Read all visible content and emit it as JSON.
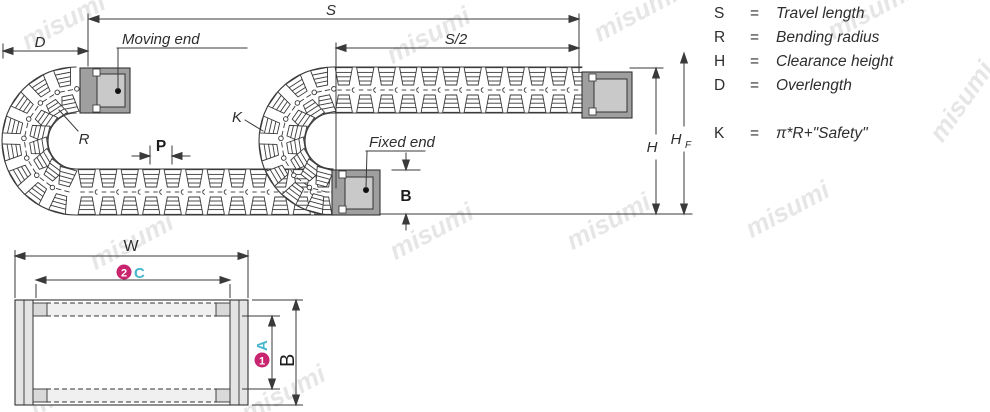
{
  "watermark": "misumi",
  "side_view": {
    "dims": {
      "s": "S",
      "s_half": "S/2",
      "d": "D",
      "p": "P",
      "b": "B",
      "h": "H",
      "hf_base": "H",
      "hf_sub": "F",
      "k": "K",
      "r": "R"
    },
    "labels": {
      "moving_end": "Moving end",
      "fixed_end": "Fixed end"
    }
  },
  "cross_section": {
    "dims": {
      "w": "W",
      "c": "C",
      "a": "A",
      "b": "B"
    },
    "callouts": {
      "one": "1",
      "two": "2"
    }
  },
  "legend": {
    "rows": [
      {
        "symbol": "S",
        "eq": "=",
        "meaning": "Travel length"
      },
      {
        "symbol": "R",
        "eq": "=",
        "meaning": "Bending radius"
      },
      {
        "symbol": "H",
        "eq": "=",
        "meaning": "Clearance height"
      },
      {
        "symbol": "D",
        "eq": "=",
        "meaning": "Overlength"
      },
      {
        "symbol": "K",
        "eq": "=",
        "meaning": "π*R+\"Safety\""
      }
    ]
  },
  "colors": {
    "magenta": "#c9256f",
    "cyan": "#45b6ce",
    "line": "#3a3a3a",
    "block_gray": "#9f9f9f",
    "panel_gray": "#c9c9c9",
    "plate_gray": "#e4e4e4"
  }
}
